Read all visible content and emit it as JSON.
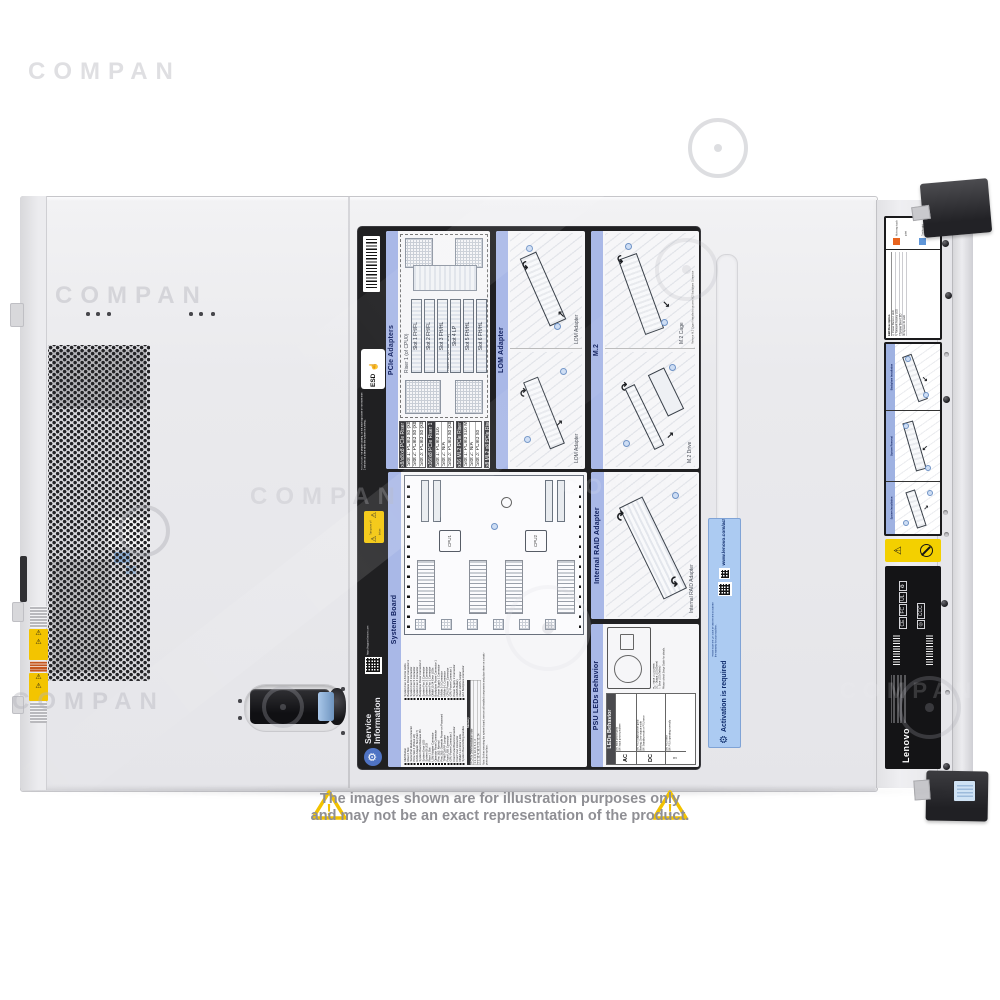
{
  "watermark": {
    "text": "COMPAN"
  },
  "disclaimer": {
    "line1": "The images shown are for illustration purposes only",
    "line2": "and may not be an exact representation of the product."
  },
  "service_label": {
    "title_line1": "Service",
    "title_line2": "Information",
    "esd": "ESD",
    "attention": "ATTENTION: For proper cooling, do not leave top cover off for more than 2 minutes at a time while the system is running.",
    "support_url": "https://support.lenovo.com",
    "mini_warning": "Turn power off before removing any non-hot swappable part.",
    "panels": {
      "pcie": {
        "title": "PCIe Adapters",
        "riser1": "Riser 1 (of CPU0)",
        "riser2": "Riser 2 (of CPU1)",
        "slots": [
          "Slot 1 FH/FL",
          "Slot 2 FH/FL",
          "Slot 3 FH/HL",
          "Slot 4 LP",
          "Slot 5 FH/HL",
          "Slot 6 FH/HL"
        ],
        "t1": {
          "header": "x8/x8/x8 PCIe Riser 1 kit",
          "rows": [
            "Slot 1: PCIe3 x8 (x8, x4, x1)",
            "Slot 2: PCIe3 x8 (x8, x4, x1)",
            "Slot 3: PCIe3 x8 (x8, x4, x1)"
          ]
        },
        "t2": {
          "header": "x16/x8 PCIe Riser 1 kit",
          "rows": [
            "Slot 1: PCIe3 x16",
            "Slot 2: N/A",
            "Slot 3: PCIe3 x8 (x8, x4, x1)"
          ]
        },
        "t3": {
          "header": "x16 ML2 PCIe Riser 1 kit",
          "rows": [
            "Slot 1: PCIe3 x16 ML2",
            "Slot 2: N/A",
            "Slot 3: PCIe3 x8"
          ]
        },
        "t4": {
          "header": "x8 ML2 x8 PCIe Riser 1 kit",
          "rows": [
            "Slot 1: PCIe3 x8 ML2",
            "Slot 2: PCIe3 x8",
            "Slot 3: PCIe3 x8"
          ]
        }
      },
      "lom": {
        "title": "LOM Adapter",
        "caption1": "LOM Adapter",
        "caption2": "LOM Adapter"
      },
      "m2": {
        "title": "M.2",
        "caption1": "M.2 Drive",
        "caption2": "M.2 Cage",
        "note": "Remove M.2 Cage if installed to access M.2 Backplane Connector"
      },
      "system_board": {
        "title": "System Board",
        "cpu1": "CPU1",
        "cpu2": "CPU2",
        "legend_left": [
          "NMI Button",
          "Riser 2 Slot",
          "Serial Port Module Connector",
          "PCIe Slot 4 (PCIe3 x8)",
          "RAID Adapter Slot (Slot 7)",
          "System Board Release Pin",
          "System Error LED",
          "System ID LED",
          "Riser 1 Slot",
          "LOM Adapter Connector",
          "Operator Panel Connector",
          "Pins 1&2: Normal",
          "Pins 2&3: Override Power-on Password",
          "TPM/TCM PP Jumper",
          "Front USB Connector",
          "GPU Power Connector 2",
          "Front Panel Board Connector",
          "Front VGA Connector",
          "DIMM 1-12 Error LEDs",
          "System Board Lifting Handles"
        ],
        "legend_right": [
          "System Fan 1-6 Error LEDs",
          "Backplane Power Connector 3",
          "System Fan 6 Connector",
          "System Fan 5 Connector",
          "System Fan 4 Connector",
          "Backplane Power Connector 2",
          "System Fan 3 Connector",
          "System Fan 2 Connector",
          "System Fan 1 Connector",
          "DIMM 13-24 Error LEDs",
          "Backplane Power Connector 1",
          "Power Supply 1 Connector",
          "NVMe 2-3 Connector",
          "NVMe 0-1 Connector",
          "CPU2 Power Connector",
          "GPU Power Connector 1",
          "Power Supply 2 Connector",
          "CMOS Battery",
          "Clear CMOS Jumper",
          "M.2 Backplane Connector"
        ],
        "memory_header": "Memory",
        "memory_rows": [
          "# CPUs   DIMM installation order",
          "1            1, 4, 9, 12, 8, 5, 2, 3",
          "2            1, 13, 4, 16, 9, 21, 12, 24"
        ],
        "note": "Note: Before removing the system board, remove all installed components and place them on a static-protective surface."
      },
      "raid": {
        "title": "Internal RAID Adapter",
        "caption": "Internal RAID Adapter"
      },
      "psu": {
        "title": "PSU LEDs Behavior",
        "legend": [
          "AC : Input LED (Green)",
          "DC : Output LED (Green)",
          "!   : Error LED (Yellow)"
        ],
        "note": "Please check Setup Guide for details.",
        "table_header": "LEDs Behavior",
        "ac_label": "AC",
        "ac_rows": [
          "On: Input power good",
          "Off: Input power problem"
        ],
        "dc_label": "DC",
        "dc_rows": [
          "On: PSU output power good",
          "Blinking: Zero-output mode",
          "Off: Standby mode or PSU error"
        ],
        "err_label": "!",
        "err_rows": [
          "On: PSU error",
          "Off: PSU operating normally"
        ]
      }
    }
  },
  "activation_label": {
    "title": "Activation is required",
    "url": "www.lenovo.com/activate",
    "note": "Please scan the QR code or visit the link to activate the warranty for your machine."
  },
  "front_rail": {
    "touch_orange": "Hot-swap touch point",
    "touch_blue": "Touch point",
    "led_header": "LED   Description",
    "led_rows": [
      "◎  Power Button / LED",
      "↯  Network Activity LED",
      "!   System Error LED",
      "ID  System ID LED"
    ],
    "panel_backplane": "Backplane Installation",
    "panel_removal": "System Removal",
    "panel_install": "System Installation"
  },
  "regulatory": {
    "brand": "Lenovo",
    "marks": [
      "CE",
      "FC",
      "UL",
      "♻",
      "◎",
      "CCC"
    ]
  }
}
